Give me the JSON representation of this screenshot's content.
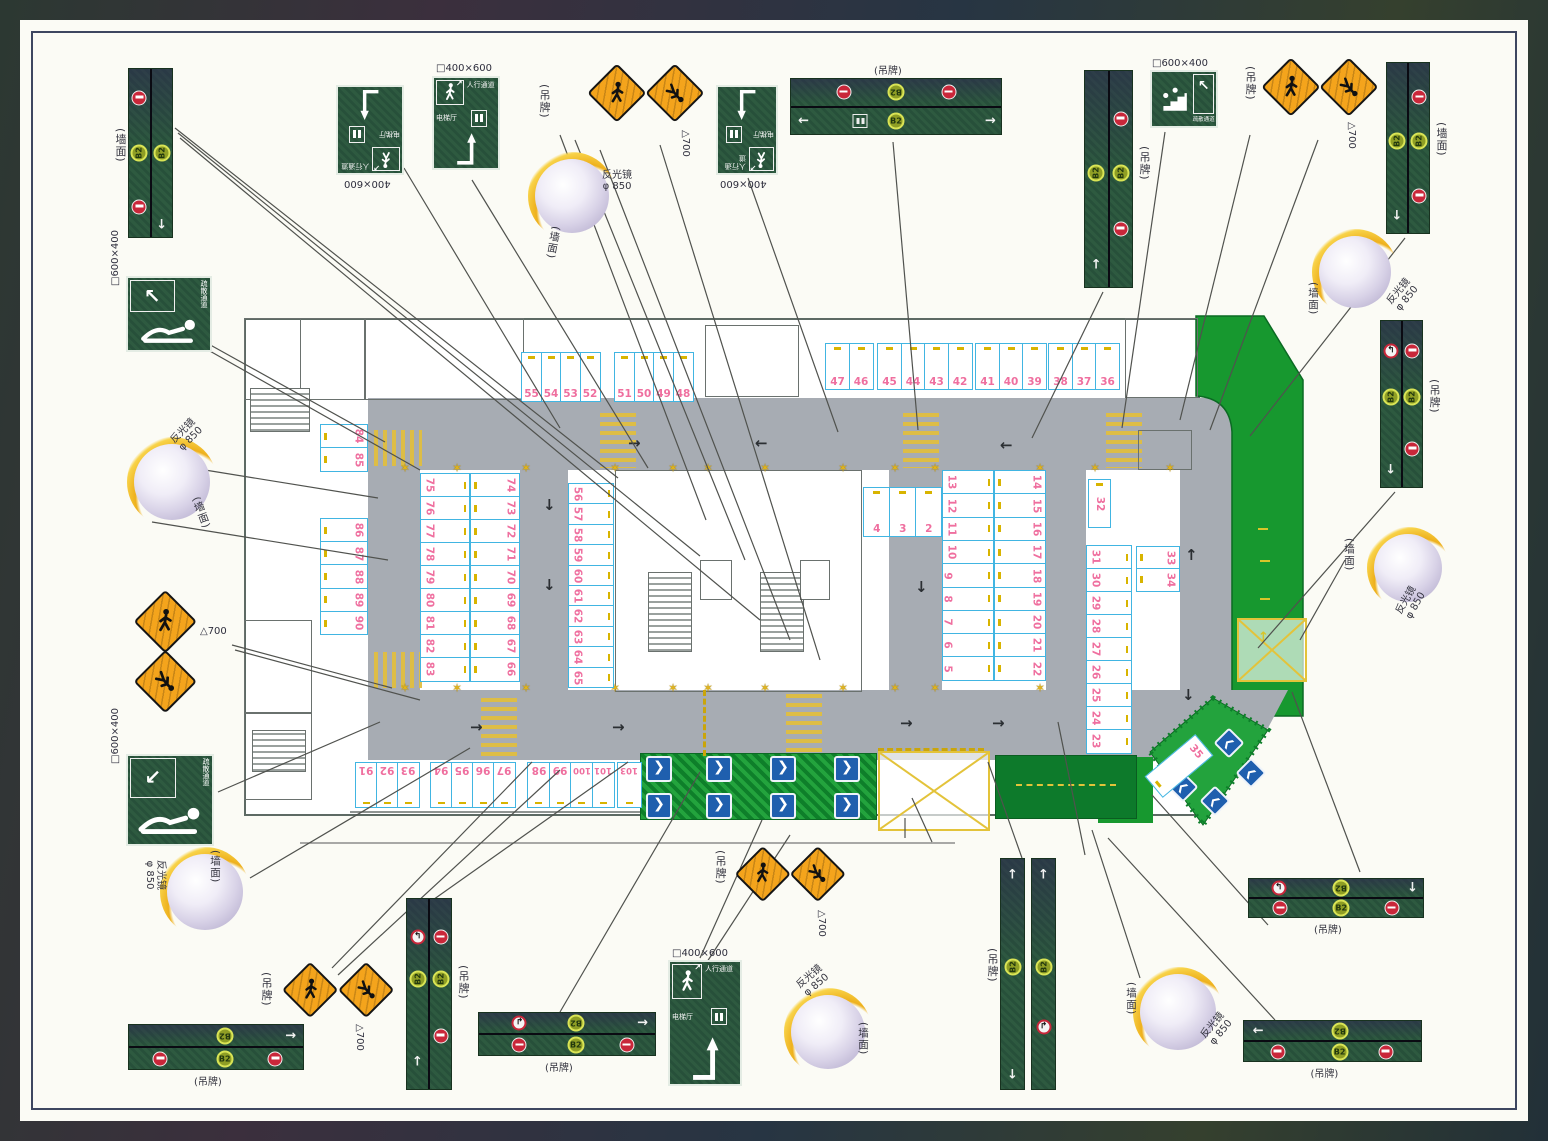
{
  "labels": {
    "hang_tag": "(吊牌)",
    "wall_face": "(墙面)",
    "mirror_line1": "反光镜",
    "mirror_line2": "φ 850",
    "tri_700": "△700",
    "dim_400x600_boxed": "□400×600",
    "dim_400x600": "400×600",
    "dim_600x400_boxed": "□600×400",
    "b2": "B2",
    "evac_route": "疏散通道",
    "ped_route": "人行通道",
    "elev_hall": "电梯厅"
  },
  "colors": {
    "sign_green": "#2e5a40",
    "b2_badge": "#8f9e25",
    "no_entry_red": "#c9273a",
    "warning_orange": "#f4a41c",
    "stall_border_cyan": "#41b5e2",
    "stall_number_pink": "#ef6f9f",
    "roadway_gray": "#a7acb3",
    "landscape_green": "#17982f",
    "chevron_blue": "#1f5fae"
  },
  "parking_groups": {
    "top_a": [
      "55",
      "54",
      "53",
      "52"
    ],
    "top_b": [
      "51",
      "50",
      "49",
      "48"
    ],
    "top_c": [
      "47",
      "46"
    ],
    "top_d": [
      "45",
      "44",
      "43",
      "42"
    ],
    "top_e": [
      "41",
      "40",
      "39"
    ],
    "top_f": [
      "38",
      "37",
      "36"
    ],
    "left_a": [
      "84",
      "85"
    ],
    "left_b": [
      "86",
      "87",
      "88",
      "89",
      "90"
    ],
    "island_left_west": [
      "75",
      "76",
      "77",
      "78",
      "79",
      "80",
      "81",
      "82",
      "83"
    ],
    "island_left_east": [
      "74",
      "73",
      "72",
      "71",
      "70",
      "69",
      "68",
      "67",
      "66"
    ],
    "mid_col": [
      "56",
      "57",
      "58",
      "59",
      "60",
      "61",
      "62",
      "63",
      "64",
      "65"
    ],
    "col_small": [
      "4",
      "3",
      "2",
      "1"
    ],
    "island_right_west": [
      "13",
      "12",
      "11",
      "10",
      "9",
      "8",
      "7",
      "6",
      "5"
    ],
    "island_right_east": [
      "14",
      "15",
      "16",
      "17",
      "18",
      "19",
      "20",
      "21",
      "22"
    ],
    "right_32": [
      "32"
    ],
    "right_col": [
      "31",
      "30",
      "29",
      "28",
      "27",
      "26",
      "25",
      "24",
      "23"
    ],
    "right_3334": [
      "33",
      "34"
    ],
    "diag_35": [
      "35"
    ],
    "bottom_a": [
      "91",
      "92",
      "93"
    ],
    "bottom_b": [
      "94",
      "95",
      "96",
      "97"
    ],
    "bottom_c": [
      "98",
      "99",
      "100",
      "101"
    ],
    "bottom_d": [
      "103"
    ]
  },
  "signs": {
    "v_top_left": {
      "bands": [
        [
          "no-entry",
          "b2",
          "no-entry"
        ],
        [
          "b2",
          "arrow-down"
        ]
      ]
    },
    "v_top_mid": {
      "bands": [
        [
          "b2",
          "arrow-up"
        ],
        [
          "no-entry",
          "b2",
          "no-entry"
        ]
      ]
    },
    "v_top_right": {
      "bands": [
        [
          "b2",
          "arrow-down"
        ],
        [
          "no-entry",
          "b2",
          "no-entry"
        ]
      ]
    },
    "v_right_mid": {
      "bands": [
        [
          "no-left",
          "b2",
          "arrow-down"
        ],
        [
          "no-entry",
          "b2",
          "no-entry"
        ]
      ]
    },
    "v_bottom": {
      "bands": [
        [
          "no-left",
          "b2",
          "arrow-up"
        ],
        [
          "no-entry",
          "b2",
          "no-entry"
        ]
      ]
    },
    "v_pair_a": {
      "bands": [
        [
          "arrow-up",
          "b2",
          "arrow-down"
        ]
      ]
    },
    "v_pair_b": {
      "bands": [
        [
          "arrow-up",
          "b2",
          "no-right"
        ]
      ]
    },
    "h_top": {
      "bands": [
        [
          "no-entry",
          "b2u",
          "no-entry"
        ],
        [
          "arrow-left",
          "elevator",
          "b2",
          "arrow-right"
        ]
      ]
    },
    "h_bot_left": {
      "bands": [
        [
          "b2u",
          "arrow-right"
        ],
        [
          "no-entry",
          "b2",
          "no-entry"
        ]
      ]
    },
    "h_bot_mid": {
      "bands": [
        [
          "no-right",
          "b2u",
          "arrow-right"
        ],
        [
          "no-entry",
          "b2",
          "no-entry"
        ]
      ]
    },
    "h_br_top": {
      "bands": [
        [
          "no-left",
          "b2u",
          "arrow-down"
        ],
        [
          "no-entry",
          "b2",
          "no-entry"
        ]
      ]
    },
    "h_br_bot": {
      "bands": [
        [
          "arrow-left",
          "b2u"
        ],
        [
          "no-entry",
          "b2",
          "no-entry"
        ]
      ]
    }
  }
}
